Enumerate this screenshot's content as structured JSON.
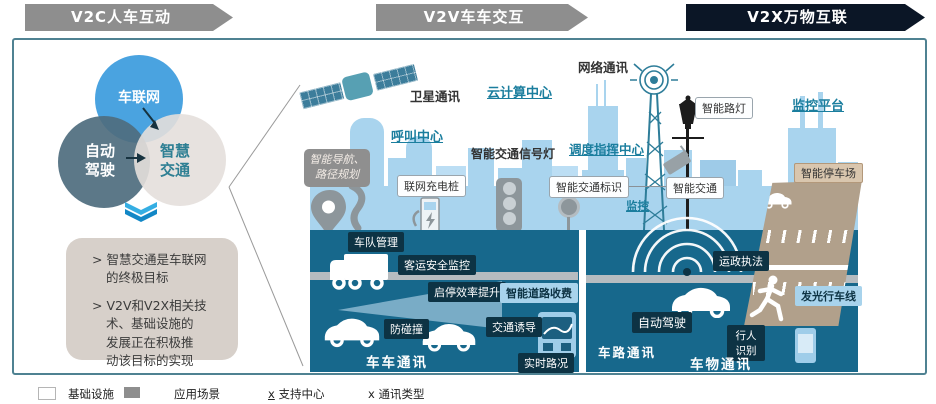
{
  "note_bullet": ">",
  "banners": [
    {
      "label": "V2C人车互动"
    },
    {
      "label": "V2V车车交互"
    },
    {
      "label": "V2X万物互联"
    }
  ],
  "venn": {
    "top": "车联网",
    "left": "自动驾驶",
    "right": "智慧交通"
  },
  "notes": [
    "智慧交通是车联网的终极目标",
    "V2V和V2X相关技术、基础设施的 发展正在积极推 动该目标的实现"
  ],
  "city": {
    "satellite_comm": "卫星通讯",
    "cloud_center": "云计算中心",
    "network_comm": "网络通讯",
    "call_center": "呼叫中心",
    "signal_light": "智能交通信号灯",
    "dispatch_center": "调度指挥中心",
    "smart_lamp": "智能路灯",
    "monitor_platform": "监控平台",
    "nav_planning": "智能导航、路径规划",
    "charging_pile": "联网充电桩",
    "traffic_sign": "智能交通标识",
    "smart_traffic": "智能交通",
    "monitor": "监控",
    "smart_parking": "智能停车场",
    "fleet_mgmt": "车队管理",
    "passenger_safety": "客运安全监控",
    "stop_start": "启停效率提升",
    "road_toll": "智能道路收费",
    "anti_collision": "防碰撞",
    "traffic_guidance": "交通诱导",
    "realtime_traffic": "实时路况",
    "law_enforcement": "运政执法",
    "auto_driving": "自动驾驶",
    "pedestrian_recog": "行人识别",
    "glow_lane": "发光行车线",
    "v2v": "车车通讯",
    "v2r": "车路通讯",
    "v2i": "车物通讯"
  },
  "legend": {
    "infra": "基础设施",
    "app": "应用场景",
    "support_x": "x",
    "support": "支持中心",
    "comm_x": "x",
    "comm": "通讯类型"
  },
  "colors": {
    "band_teal": "#17688c",
    "city_blue": "#a9d4ee",
    "app_box": "#0d3344",
    "banner_gray": "#8e8e8e",
    "banner_dark": "#0b1626",
    "support_text": "#1b7e9e",
    "accent_chevron": "#1d9bd8"
  }
}
